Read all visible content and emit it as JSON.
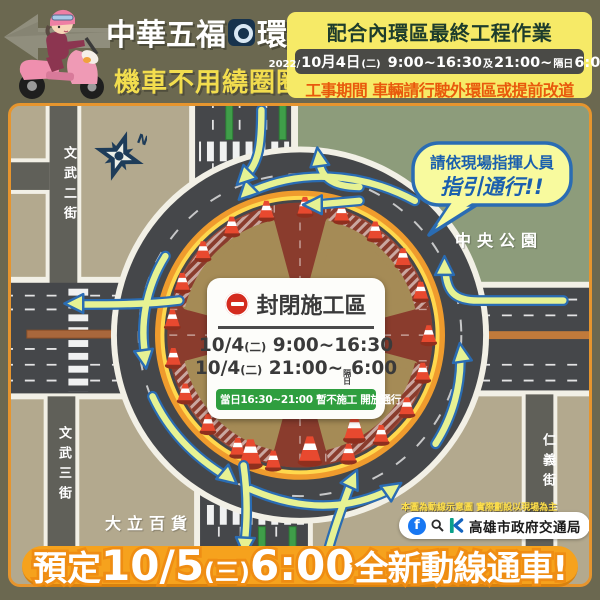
{
  "header": {
    "title_part1": "中華五福",
    "round_char": "圓",
    "title_part2": "環",
    "subtitle": "機車不用繞圈圈",
    "notice": {
      "line1": "配合內環區最終工程作業",
      "year": "2022/",
      "date": "10月4日",
      "day": "(二)",
      "time1": "9:00~16:30",
      "conj": "及",
      "time2": "21:00~",
      "next_day": "隔日",
      "time3": "6:00",
      "line3": "工事期間 車輛請行駛外環區或提前改道"
    }
  },
  "map": {
    "compass_n": "N",
    "street_left_top": "文武二街",
    "street_left_bottom": "文武三街",
    "street_right": "仁義街",
    "park_label": "中央公園",
    "landmark_label": "大立百貨",
    "bubble": {
      "line1": "請依現場指揮人員",
      "line2": "指引通行!!"
    },
    "closure_box": {
      "title": "封閉施工區",
      "schedule1": {
        "date": "10/4",
        "day": "(二)",
        "time": "9:00~16:30"
      },
      "schedule2": {
        "date": "10/4",
        "day": "(二)",
        "time_start": "21:00~",
        "small_top": "隔",
        "small_bottom": "日",
        "time_end": "6:00"
      },
      "note": "當日16:30~21:00 暫不施工 開放通行"
    },
    "disclaimer": "本圖為動線示意圖 實際劃設以現場為主"
  },
  "footer": {
    "agency": "高雄市政府交通局",
    "banner": {
      "pre": "預定",
      "date": "10/5",
      "day": "(三)",
      "time": "6:00",
      "post": "全新動線通車!"
    }
  },
  "colors": {
    "page_bg": "#6b6850",
    "map_ground": "#b3a98e",
    "park_green": "#8d9c7b",
    "road_dark": "#45474a",
    "side_street": "#606059",
    "closed_zone_red": "#9c4a38",
    "inner_road_red": "#8a3c2d",
    "island_tan": "#a58b56",
    "rim_orange": "#ef9b2d",
    "rim_yellow": "#ffd84d",
    "cone_red": "#e8492f",
    "arrow_fill": "#e6f293",
    "arrow_outline": "#2a6cb3",
    "notice_bg": "#f6ea67",
    "notice_title": "#1d3c2c",
    "notice_warning": "#e8590c",
    "banner_orange": "#f6a21d",
    "note_green": "#2f9e3f",
    "no_entry_red": "#d42b1e",
    "facebook_blue": "#1877f2"
  }
}
